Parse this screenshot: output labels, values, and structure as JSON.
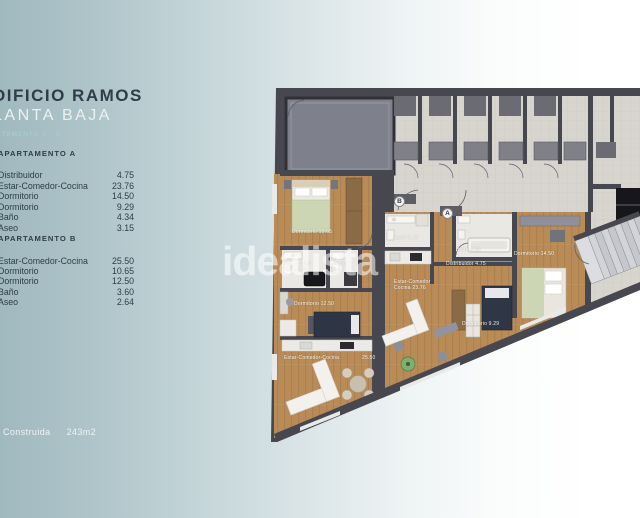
{
  "info_panel": {
    "title": "DIFICIO RAMOS",
    "subtitle": "LANTA BAJA",
    "apartments_line": "RTAMENTO A - B",
    "section_a": {
      "header": "APARTAMENTO A",
      "rows": [
        {
          "label": "Distribuidor",
          "value": "4.75"
        },
        {
          "label": "Estar-Comedor-Cocina",
          "value": "23.76"
        },
        {
          "label": "Dormitorio",
          "value": "14.50"
        },
        {
          "label": "Dormitorio",
          "value": "9.29"
        },
        {
          "label": "Baño",
          "value": "4.34"
        },
        {
          "label": "Aseo",
          "value": "3.15"
        }
      ]
    },
    "section_b": {
      "header": "APARTAMENTO B",
      "rows": [
        {
          "label": "Estar-Comedor-Cocina",
          "value": "25.50"
        },
        {
          "label": "Dormitorio",
          "value": "10.65"
        },
        {
          "label": "Dormitorio",
          "value": "12.50"
        },
        {
          "label": "Baño",
          "value": "3.60"
        },
        {
          "label": "Aseo",
          "value": "2.64"
        }
      ]
    },
    "footer": {
      "label": "Construida",
      "value": "243m2"
    }
  },
  "watermark": "idealista",
  "floorplan": {
    "unit_markers": [
      "B",
      "A"
    ],
    "labels": [
      "Dormitorio 10.65",
      "Baño",
      "3.60",
      "Aseo",
      "2.64",
      "Dormitorio 12.50",
      "Estar-Comedor-Cocina",
      "25.50",
      "Aseo 3.15",
      "Estar-Comedor",
      "Cocina 23.76",
      "Baño 4.34",
      "Distribuidor 4.75",
      "Dormitorio 14.50",
      "Dormitorio 9.29"
    ],
    "colors": {
      "wall": "#47474f",
      "wood": "#b88b57",
      "tile": "#d8d5cf",
      "patio": "#7e818b",
      "bath": "#eae8e4",
      "background_left": "#a0b9bf",
      "text_dark": "#2e3d48",
      "text_teal": "#a5cbd2"
    }
  }
}
